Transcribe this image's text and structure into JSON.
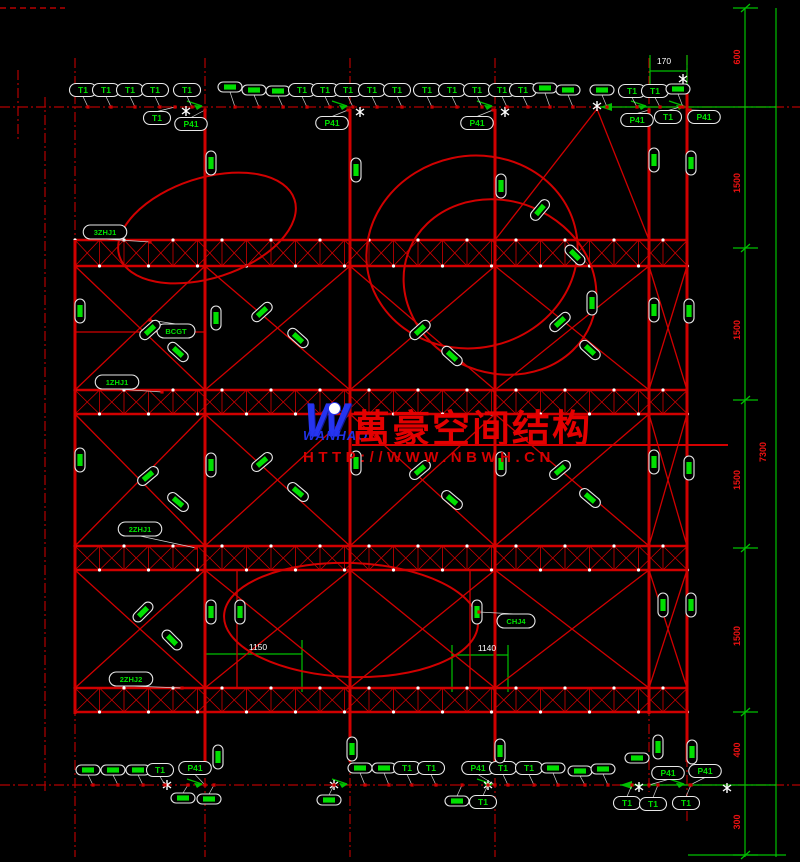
{
  "canvas": {
    "width": 800,
    "height": 862,
    "background": "#000000"
  },
  "colors": {
    "structure_red": "#d10000",
    "grid_red": "#b40000",
    "dim_green": "#00c000",
    "label_green": "#00e000",
    "callout_stroke": "#e8e8e8",
    "dim_text_red": "#ee1111",
    "white": "#ffffff",
    "logo_blue": "#2634f0",
    "watermark_red": "#e40000"
  },
  "watermark": {
    "logo_letter": "W",
    "logo_text": "WANHAO",
    "cn_text": "萬豪空间结构",
    "url_text": "HTTP://WWW.NBWH.CN"
  },
  "dim_texts_right": [
    {
      "x": 740,
      "y": 57,
      "t": "600"
    },
    {
      "x": 740,
      "y": 183,
      "t": "1500"
    },
    {
      "x": 740,
      "y": 330,
      "t": "1500"
    },
    {
      "x": 740,
      "y": 480,
      "t": "1500"
    },
    {
      "x": 740,
      "y": 636,
      "t": "1500"
    },
    {
      "x": 740,
      "y": 750,
      "t": "400"
    },
    {
      "x": 740,
      "y": 822,
      "t": "300"
    },
    {
      "x": 766,
      "y": 452,
      "t": "7300"
    }
  ],
  "white_texts": [
    {
      "x": 664,
      "y": 64,
      "t": "170"
    },
    {
      "x": 258,
      "y": 650,
      "t": "1150"
    },
    {
      "x": 487,
      "y": 651,
      "t": "1140"
    }
  ],
  "labels": [
    {
      "x": 83,
      "y": 90,
      "r": 0,
      "t": "T1",
      "ay": 107
    },
    {
      "x": 106,
      "y": 90,
      "r": 0,
      "t": "T1",
      "ay": 107
    },
    {
      "x": 130,
      "y": 90,
      "r": 0,
      "t": "T1",
      "ay": 107
    },
    {
      "x": 155,
      "y": 90,
      "r": 0,
      "t": "T1",
      "ay": 107
    },
    {
      "x": 187,
      "y": 90,
      "r": 0,
      "t": "T1",
      "ay": 107
    },
    {
      "x": 230,
      "y": 87,
      "r": 0,
      "t": "",
      "ay": 107
    },
    {
      "x": 254,
      "y": 90,
      "r": 0,
      "t": "",
      "ay": 107
    },
    {
      "x": 278,
      "y": 91,
      "r": 0,
      "t": "",
      "ay": 107
    },
    {
      "x": 302,
      "y": 90,
      "r": 0,
      "t": "T1",
      "ay": 107
    },
    {
      "x": 325,
      "y": 90,
      "r": 0,
      "t": "T1",
      "ay": 107
    },
    {
      "x": 348,
      "y": 90,
      "r": 0,
      "t": "T1",
      "ay": 107
    },
    {
      "x": 372,
      "y": 90,
      "r": 0,
      "t": "T1",
      "ay": 107
    },
    {
      "x": 397,
      "y": 90,
      "r": 0,
      "t": "T1",
      "ay": 107
    },
    {
      "x": 427,
      "y": 90,
      "r": 0,
      "t": "T1",
      "ay": 107
    },
    {
      "x": 452,
      "y": 90,
      "r": 0,
      "t": "T1",
      "ay": 107
    },
    {
      "x": 477,
      "y": 90,
      "r": 0,
      "t": "T1",
      "ay": 107
    },
    {
      "x": 502,
      "y": 90,
      "r": 0,
      "t": "T1",
      "ay": 107
    },
    {
      "x": 523,
      "y": 90,
      "r": 0,
      "t": "T1",
      "ay": 107
    },
    {
      "x": 545,
      "y": 88,
      "r": 0,
      "t": "",
      "ay": 107
    },
    {
      "x": 568,
      "y": 90,
      "r": 0,
      "t": "",
      "ay": 107
    },
    {
      "x": 602,
      "y": 90,
      "r": 0,
      "t": "",
      "ay": 107
    },
    {
      "x": 632,
      "y": 91,
      "r": 0,
      "t": "T1",
      "ay": 107
    },
    {
      "x": 655,
      "y": 91,
      "r": 0,
      "t": "T1",
      "ay": 107
    },
    {
      "x": 678,
      "y": 89,
      "r": 0,
      "t": "",
      "ay": 107
    },
    {
      "x": 157,
      "y": 118,
      "r": 0,
      "t": "T1",
      "ax": 175,
      "ay": 107
    },
    {
      "x": 668,
      "y": 117,
      "r": 0,
      "t": "T1",
      "ax": 680,
      "ay": 107
    },
    {
      "x": 191,
      "y": 124,
      "r": 0,
      "t": "P41",
      "ax": 205,
      "ay": 110
    },
    {
      "x": 332,
      "y": 123,
      "r": 0,
      "t": "P41",
      "ax": 348,
      "ay": 110
    },
    {
      "x": 477,
      "y": 123,
      "r": 0,
      "t": "P41",
      "ax": 493,
      "ay": 110
    },
    {
      "x": 637,
      "y": 120,
      "r": 0,
      "t": "P41",
      "ax": 649,
      "ay": 110
    },
    {
      "x": 704,
      "y": 117,
      "r": 0,
      "t": "P41",
      "ax": 690,
      "ay": 110
    },
    {
      "x": 88,
      "y": 770,
      "r": 0,
      "t": "",
      "ay": 785
    },
    {
      "x": 113,
      "y": 770,
      "r": 0,
      "t": "",
      "ay": 785
    },
    {
      "x": 138,
      "y": 770,
      "r": 0,
      "t": "",
      "ay": 785
    },
    {
      "x": 160,
      "y": 770,
      "r": 0,
      "t": "T1",
      "ay": 785
    },
    {
      "x": 195,
      "y": 768,
      "r": 0,
      "t": "P41",
      "ax": 205,
      "ay": 785
    },
    {
      "x": 360,
      "y": 768,
      "r": 0,
      "t": "",
      "ay": 785
    },
    {
      "x": 384,
      "y": 768,
      "r": 0,
      "t": "",
      "ay": 785
    },
    {
      "x": 407,
      "y": 768,
      "r": 0,
      "t": "T1",
      "ay": 785
    },
    {
      "x": 431,
      "y": 768,
      "r": 0,
      "t": "T1",
      "ay": 785
    },
    {
      "x": 478,
      "y": 768,
      "r": 0,
      "t": "P41",
      "ax": 495,
      "ay": 785
    },
    {
      "x": 503,
      "y": 768,
      "r": 0,
      "t": "T1",
      "ay": 785
    },
    {
      "x": 529,
      "y": 768,
      "r": 0,
      "t": "T1",
      "ay": 785
    },
    {
      "x": 553,
      "y": 768,
      "r": 0,
      "t": "",
      "ay": 785
    },
    {
      "x": 580,
      "y": 771,
      "r": 0,
      "t": "",
      "ay": 785
    },
    {
      "x": 603,
      "y": 769,
      "r": 0,
      "t": "",
      "ay": 785
    },
    {
      "x": 668,
      "y": 773,
      "r": 0,
      "t": "P41",
      "ax": 649,
      "ay": 785
    },
    {
      "x": 705,
      "y": 771,
      "r": 0,
      "t": "P41",
      "ax": 690,
      "ay": 785
    },
    {
      "x": 183,
      "y": 798,
      "r": 0,
      "t": "",
      "ay": 785
    },
    {
      "x": 209,
      "y": 799,
      "r": 0,
      "t": "",
      "ay": 785
    },
    {
      "x": 329,
      "y": 800,
      "r": 0,
      "t": "",
      "ay": 785
    },
    {
      "x": 457,
      "y": 801,
      "r": 0,
      "t": "",
      "ay": 785
    },
    {
      "x": 483,
      "y": 802,
      "r": 0,
      "t": "T1",
      "ay": 785
    },
    {
      "x": 627,
      "y": 803,
      "r": 0,
      "t": "T1",
      "ay": 785
    },
    {
      "x": 653,
      "y": 804,
      "r": 0,
      "t": "T1",
      "ay": 785
    },
    {
      "x": 686,
      "y": 803,
      "r": 0,
      "t": "T1",
      "ay": 785
    },
    {
      "x": 218,
      "y": 757,
      "r": -90,
      "t": ""
    },
    {
      "x": 352,
      "y": 749,
      "r": -90,
      "t": ""
    },
    {
      "x": 500,
      "y": 751,
      "r": -90,
      "t": ""
    },
    {
      "x": 658,
      "y": 747,
      "r": -90,
      "t": ""
    },
    {
      "x": 692,
      "y": 752,
      "r": -90,
      "t": ""
    },
    {
      "x": 637,
      "y": 758,
      "r": 0,
      "t": ""
    },
    {
      "x": 211,
      "y": 163,
      "r": -90,
      "t": ""
    },
    {
      "x": 356,
      "y": 170,
      "r": -90,
      "t": ""
    },
    {
      "x": 501,
      "y": 186,
      "r": -90,
      "t": ""
    },
    {
      "x": 654,
      "y": 160,
      "r": -90,
      "t": ""
    },
    {
      "x": 691,
      "y": 163,
      "r": -90,
      "t": ""
    },
    {
      "x": 80,
      "y": 311,
      "r": -90,
      "t": ""
    },
    {
      "x": 216,
      "y": 318,
      "r": -90,
      "t": ""
    },
    {
      "x": 592,
      "y": 303,
      "r": -90,
      "t": ""
    },
    {
      "x": 654,
      "y": 310,
      "r": -90,
      "t": ""
    },
    {
      "x": 689,
      "y": 311,
      "r": -90,
      "t": ""
    },
    {
      "x": 80,
      "y": 460,
      "r": -90,
      "t": ""
    },
    {
      "x": 211,
      "y": 465,
      "r": -90,
      "t": ""
    },
    {
      "x": 356,
      "y": 463,
      "r": -90,
      "t": ""
    },
    {
      "x": 501,
      "y": 464,
      "r": -90,
      "t": ""
    },
    {
      "x": 654,
      "y": 462,
      "r": -90,
      "t": ""
    },
    {
      "x": 689,
      "y": 468,
      "r": -90,
      "t": ""
    },
    {
      "x": 211,
      "y": 612,
      "r": -90,
      "t": ""
    },
    {
      "x": 240,
      "y": 612,
      "r": -90,
      "t": ""
    },
    {
      "x": 477,
      "y": 612,
      "r": -90,
      "t": ""
    },
    {
      "x": 663,
      "y": 605,
      "r": -90,
      "t": ""
    },
    {
      "x": 691,
      "y": 605,
      "r": -90,
      "t": ""
    },
    {
      "x": 105,
      "y": 232,
      "r": 0,
      "t": "3ZHJ1",
      "ax": 150,
      "ay": 242
    },
    {
      "x": 117,
      "y": 382,
      "r": 0,
      "t": "1ZHJ1",
      "ax": 162,
      "ay": 392
    },
    {
      "x": 140,
      "y": 529,
      "r": 0,
      "t": "2ZHJ1",
      "ax": 196,
      "ay": 548
    },
    {
      "x": 131,
      "y": 679,
      "r": 0,
      "t": "2ZHJ2",
      "ax": 182,
      "ay": 688
    },
    {
      "x": 516,
      "y": 621,
      "r": 0,
      "t": "CHJ4",
      "ax": 479,
      "ay": 612
    },
    {
      "x": 176,
      "y": 331,
      "r": 0,
      "t": "BCGT",
      "ax": 150,
      "ay": 320
    },
    {
      "x": 150,
      "y": 330,
      "r": -42,
      "t": ""
    },
    {
      "x": 178,
      "y": 352,
      "r": 42,
      "t": ""
    },
    {
      "x": 262,
      "y": 312,
      "r": -42,
      "t": ""
    },
    {
      "x": 298,
      "y": 338,
      "r": 42,
      "t": ""
    },
    {
      "x": 420,
      "y": 330,
      "r": -42,
      "t": ""
    },
    {
      "x": 452,
      "y": 356,
      "r": 42,
      "t": ""
    },
    {
      "x": 560,
      "y": 322,
      "r": -42,
      "t": ""
    },
    {
      "x": 590,
      "y": 350,
      "r": 42,
      "t": ""
    },
    {
      "x": 148,
      "y": 476,
      "r": -40,
      "t": ""
    },
    {
      "x": 178,
      "y": 502,
      "r": 40,
      "t": ""
    },
    {
      "x": 262,
      "y": 462,
      "r": -40,
      "t": ""
    },
    {
      "x": 298,
      "y": 492,
      "r": 40,
      "t": ""
    },
    {
      "x": 420,
      "y": 470,
      "r": -40,
      "t": ""
    },
    {
      "x": 452,
      "y": 500,
      "r": 40,
      "t": ""
    },
    {
      "x": 560,
      "y": 470,
      "r": -40,
      "t": ""
    },
    {
      "x": 590,
      "y": 498,
      "r": 40,
      "t": ""
    },
    {
      "x": 143,
      "y": 612,
      "r": -45,
      "t": ""
    },
    {
      "x": 172,
      "y": 640,
      "r": 45,
      "t": ""
    },
    {
      "x": 540,
      "y": 210,
      "r": -50,
      "t": ""
    },
    {
      "x": 575,
      "y": 255,
      "r": 45,
      "t": ""
    }
  ],
  "structure": {
    "grid_v": [
      {
        "x": 18,
        "y1": 70,
        "y2": 142
      },
      {
        "x": 45,
        "y1": 97,
        "y2": 792
      },
      {
        "x": 75,
        "y1": 58,
        "y2": 857
      },
      {
        "x": 205,
        "y1": 58,
        "y2": 857
      },
      {
        "x": 350,
        "y1": 58,
        "y2": 857
      },
      {
        "x": 495,
        "y1": 58,
        "y2": 857
      },
      {
        "x": 649,
        "y1": 58,
        "y2": 792
      },
      {
        "x": 687,
        "y1": 55,
        "y2": 822
      }
    ],
    "grid_h": [
      {
        "y": 107,
        "x1": 0,
        "x2": 800
      },
      {
        "y": 785,
        "x1": 0,
        "x2": 800
      }
    ],
    "grid_dash_h": [
      {
        "y": 8,
        "x1": 0,
        "x2": 65
      }
    ],
    "columns": [
      {
        "x": 75,
        "y1": 240,
        "y2": 714
      },
      {
        "x": 205,
        "y1": 109,
        "y2": 762
      },
      {
        "x": 350,
        "y1": 109,
        "y2": 762
      },
      {
        "x": 495,
        "y1": 109,
        "y2": 762
      },
      {
        "x": 649,
        "y1": 109,
        "y2": 714
      },
      {
        "x": 687,
        "y1": 88,
        "y2": 762
      }
    ],
    "bands": [
      {
        "y1": 240,
        "y2": 266,
        "x1": 75,
        "x2": 688
      },
      {
        "y1": 390,
        "y2": 414,
        "x1": 75,
        "x2": 688
      },
      {
        "y1": 546,
        "y2": 570,
        "x1": 75,
        "x2": 688
      },
      {
        "y1": 688,
        "y2": 712,
        "x1": 75,
        "x2": 688
      }
    ],
    "brace_levels": [
      [
        266,
        390
      ],
      [
        414,
        546
      ],
      [
        570,
        688
      ]
    ],
    "bays": [
      [
        75,
        205
      ],
      [
        205,
        350
      ],
      [
        350,
        495
      ],
      [
        495,
        649
      ],
      [
        649,
        687
      ]
    ],
    "extra_lines": [
      {
        "x1": 495,
        "y1": 240,
        "x2": 597,
        "y2": 109
      },
      {
        "x1": 649,
        "y1": 240,
        "x2": 597,
        "y2": 109
      },
      {
        "x1": 75,
        "y1": 332,
        "x2": 205,
        "y2": 332
      },
      {
        "x1": 237,
        "y1": 570,
        "x2": 237,
        "y2": 688
      },
      {
        "x1": 470,
        "y1": 570,
        "x2": 470,
        "y2": 688
      }
    ],
    "ellipses": [
      {
        "cx": 207,
        "cy": 228,
        "rx": 92,
        "ry": 50,
        "rot": -18
      },
      {
        "cx": 472,
        "cy": 252,
        "rx": 106,
        "ry": 96,
        "rot": -12
      },
      {
        "cx": 500,
        "cy": 287,
        "rx": 98,
        "ry": 86,
        "rot": 22
      },
      {
        "cx": 351,
        "cy": 620,
        "rx": 127,
        "ry": 57,
        "rot": 2
      }
    ],
    "green_lines": [
      {
        "x1": 745,
        "y1": 8,
        "x2": 745,
        "y2": 857
      },
      {
        "x1": 776,
        "y1": 8,
        "x2": 776,
        "y2": 857
      },
      {
        "x1": 600,
        "y1": 107,
        "x2": 776,
        "y2": 107,
        "arrow": true
      },
      {
        "x1": 620,
        "y1": 785,
        "x2": 776,
        "y2": 785,
        "arrow": true
      },
      {
        "x1": 650,
        "y1": 71,
        "x2": 687,
        "y2": 71
      },
      {
        "x1": 650,
        "y1": 55,
        "x2": 650,
        "y2": 95
      },
      {
        "x1": 687,
        "y1": 55,
        "x2": 687,
        "y2": 95
      },
      {
        "x1": 688,
        "y1": 855,
        "x2": 786,
        "y2": 855
      },
      {
        "x1": 205,
        "y1": 654,
        "x2": 302,
        "y2": 654
      },
      {
        "x1": 452,
        "y1": 655,
        "x2": 508,
        "y2": 655
      },
      {
        "x1": 302,
        "y1": 640,
        "x2": 302,
        "y2": 692
      },
      {
        "x1": 452,
        "y1": 645,
        "x2": 452,
        "y2": 692
      },
      {
        "x1": 508,
        "y1": 645,
        "x2": 508,
        "y2": 692
      }
    ],
    "green_ticks_y": [
      8,
      248,
      400,
      548,
      712,
      855
    ],
    "green_arrows": [
      [
        205,
        107
      ],
      [
        350,
        107
      ],
      [
        495,
        107
      ],
      [
        649,
        107
      ],
      [
        687,
        107
      ],
      [
        205,
        785
      ],
      [
        350,
        785
      ],
      [
        495,
        785
      ],
      [
        687,
        785
      ]
    ],
    "break_marks": [
      [
        186,
        111
      ],
      [
        360,
        112
      ],
      [
        505,
        112
      ],
      [
        597,
        106
      ],
      [
        683,
        79
      ],
      [
        167,
        785
      ],
      [
        334,
        785
      ],
      [
        488,
        785
      ],
      [
        639,
        787
      ],
      [
        727,
        788
      ]
    ]
  }
}
